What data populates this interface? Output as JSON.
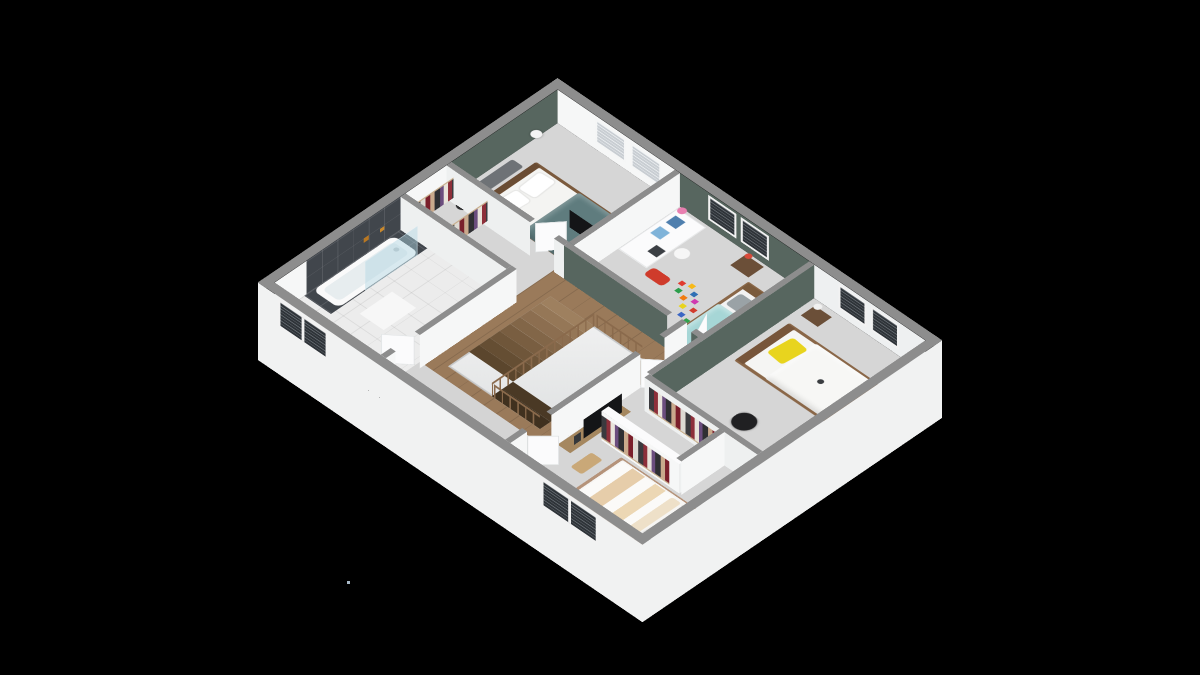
{
  "scene": {
    "description": "3D isometric cut-away floor plan render of an upper storey on a black background, viewed from above at an angle",
    "visible_text": [],
    "background": "#000000",
    "artifact_dot": {
      "x": 347,
      "y": 581,
      "color": "#a8b8c6"
    }
  },
  "colors": {
    "background": "#000000",
    "cap": "#8d8d8d",
    "wall": "#f6f7f7",
    "wall_shade": "#eef0f0",
    "skirt": "#f1f2f2",
    "green": "#57665f",
    "floor": "#d6d6d6",
    "wood": "#9a7a5a",
    "rail": "#8a6a4c",
    "tile_dark": "#41464c",
    "bath_floor": "#ececec",
    "teal": "#5f7c7e",
    "aqua": "#a6d6d6",
    "yellow": "#e8d41e",
    "beige": "#e6cdaa",
    "bed_wood": "#8a6748",
    "light_wood": "#b5937a",
    "oak": "#a5875f",
    "red": "#cf3b2b",
    "pink": "#e87fb0",
    "blue": "#4f7fae",
    "black": "#141517",
    "grey_bench": "#6e7276",
    "white": "#f4f4f3",
    "glass": "rgba(176,212,226,0.45)",
    "slat_dark": "#2e3338",
    "slat_light": "#c8cdd2"
  },
  "rooms": [
    {
      "name": "master-bedroom",
      "position": "top",
      "accent_wall": "sage-green",
      "windows": 2,
      "furniture": [
        "double-bed-teal-duvet",
        "wood-headboard",
        "grey-bench",
        "sphere-floor-lamp",
        "side-table-with-lamp",
        "dark-tv-panel"
      ]
    },
    {
      "name": "walk-in-closet",
      "position": "left-of-master",
      "furniture": [
        "clothes-rack",
        "clothes-rack"
      ]
    },
    {
      "name": "bathroom",
      "position": "left",
      "windows": 1,
      "furniture": [
        "bathtub",
        "glass-shower-screen",
        "dark-tile-accent-wall",
        "bath-mat",
        "toiletry-bottles"
      ]
    },
    {
      "name": "hallway",
      "position": "center",
      "furniture": [
        "wood-floor",
        "staircase",
        "balustrade"
      ]
    },
    {
      "name": "kids-room",
      "position": "center-right",
      "accent_wall": "sage-green",
      "windows": 2,
      "furniture": [
        "cube-shelf-blue-bins",
        "pink-lamp",
        "white-chair",
        "red-toy-car",
        "toy-blocks",
        "single-bed-aqua",
        "nightstand-with-lamp"
      ]
    },
    {
      "name": "bedroom-yellow",
      "position": "right",
      "accent_wall": "sage-green",
      "windows": 2,
      "furniture": [
        "double-bed-white",
        "yellow-pillow",
        "nightstand",
        "book-cabinet",
        "desk",
        "black-office-chair",
        "white-cabinet",
        "open-clothes-rack"
      ]
    },
    {
      "name": "bedroom-bottom",
      "position": "bottom",
      "windows": 1,
      "furniture": [
        "double-bed-beige-runners",
        "tv-sideboard",
        "flat-tv",
        "picture-frame",
        "wood-bench",
        "nightstand",
        "freestanding-wardrobe",
        "open-clothes-rack"
      ]
    }
  ],
  "staircase": {
    "flights": 2,
    "upper_treads": 8,
    "turn_treads": 2,
    "material": "wood",
    "balustrade": "wood-posts"
  }
}
